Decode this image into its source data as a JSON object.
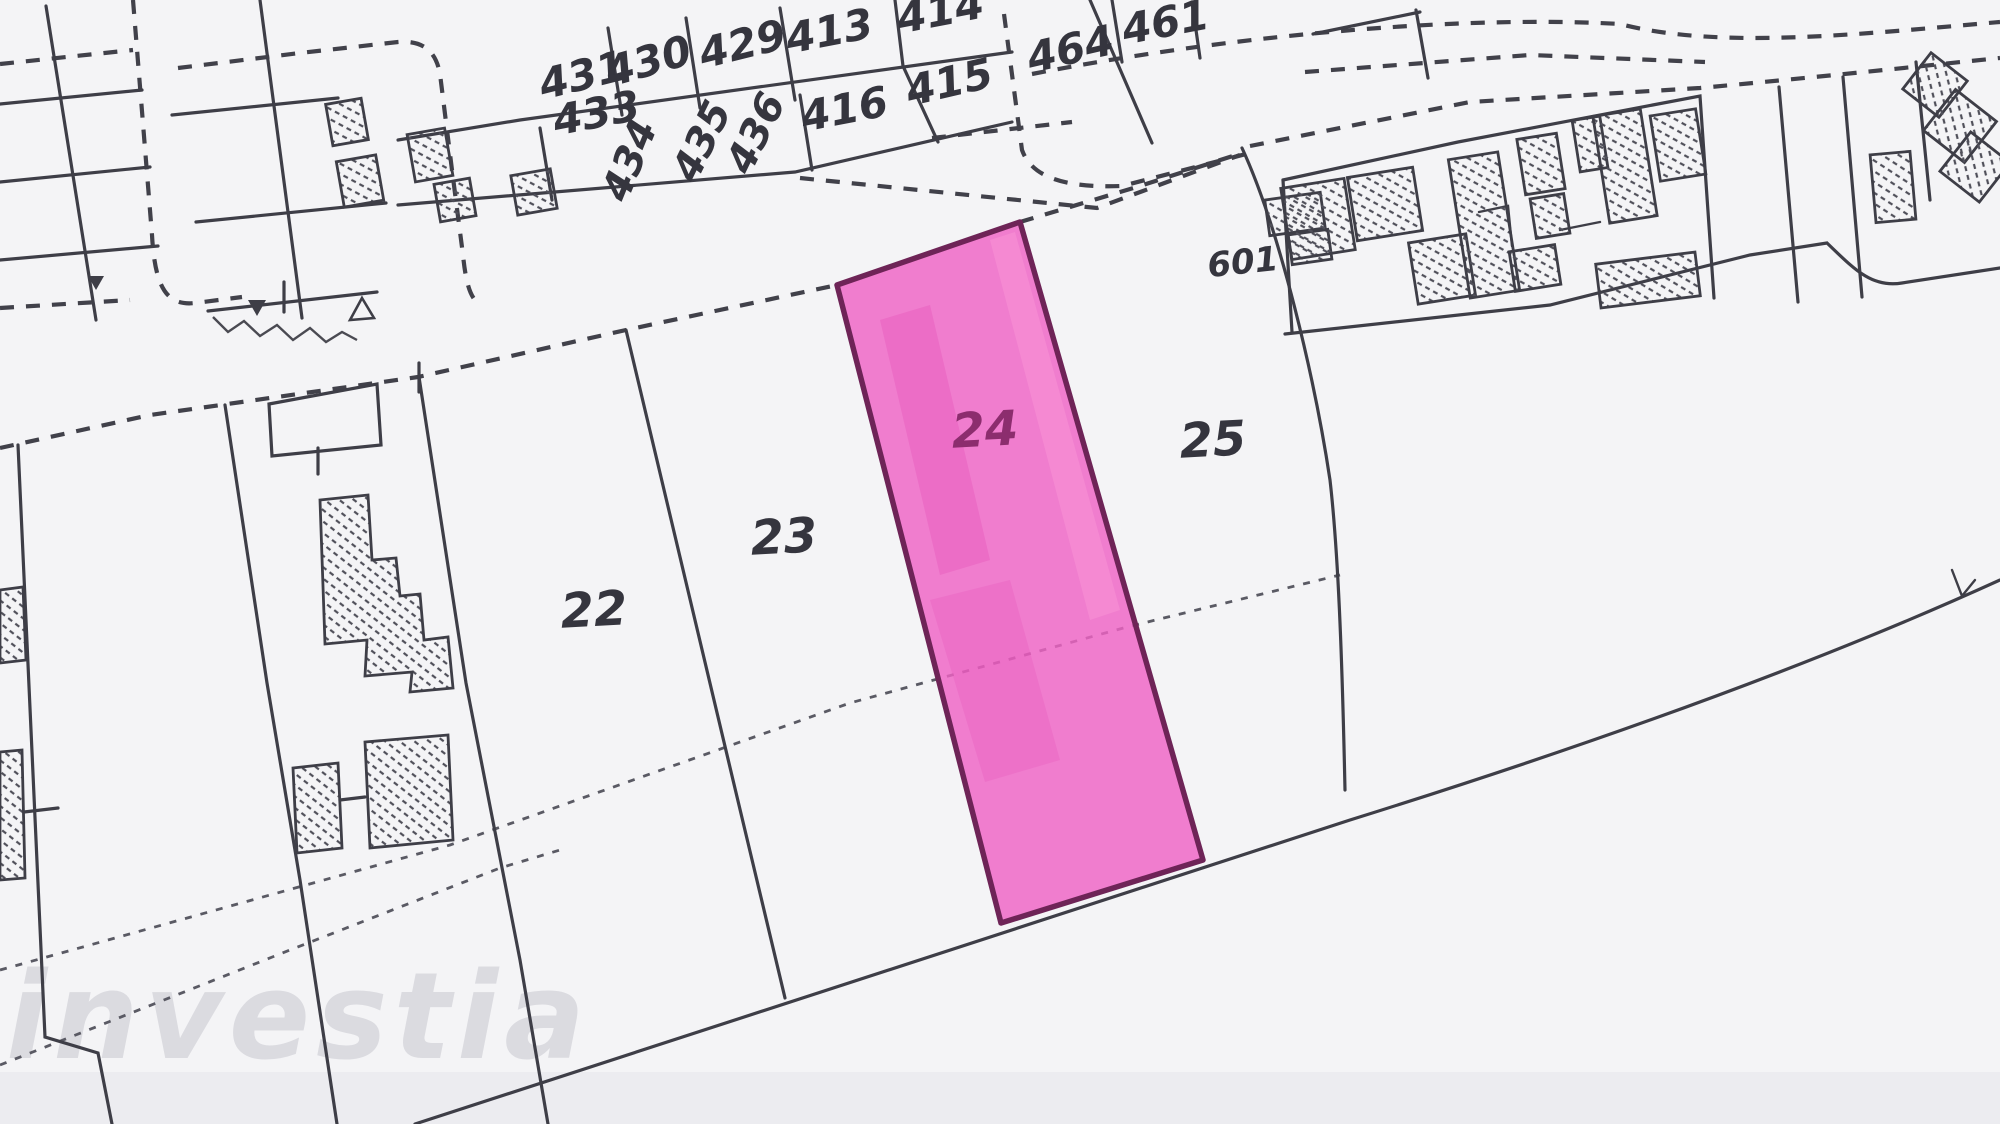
{
  "title": "Scanned cadastral plot plan with parcel 24 highlighted",
  "colors": {
    "background": "#f4f4f6",
    "line": "#3e3e47",
    "dash": "#41414a",
    "fine_dash": "#5a5a64",
    "hatch": "#50505a",
    "label": "#35353e",
    "label_highlight": "#8c2d6e",
    "parcel_fill": "#ef63c5",
    "parcel_outline": "#6e2457",
    "watermark": "#d7d7dd"
  },
  "watermark": {
    "text": "investia"
  },
  "highlighted_parcel": {
    "id": "24",
    "fill": "#ef63c5",
    "outline": "#6e2457"
  },
  "parcel_labels": [
    {
      "id": "431",
      "text": "431",
      "x": 583,
      "y": 78,
      "rot": -14,
      "size": 42
    },
    {
      "id": "433",
      "text": "433",
      "x": 597,
      "y": 116,
      "rot": -11,
      "size": 42
    },
    {
      "id": "430",
      "text": "430",
      "x": 649,
      "y": 64,
      "rot": -16,
      "size": 42
    },
    {
      "id": "429",
      "text": "429",
      "x": 743,
      "y": 47,
      "rot": -14,
      "size": 42
    },
    {
      "id": "413",
      "text": "413",
      "x": 830,
      "y": 34,
      "rot": -11,
      "size": 42
    },
    {
      "id": "414",
      "text": "414",
      "x": 941,
      "y": 14,
      "rot": -11,
      "size": 42
    },
    {
      "id": "415",
      "text": "415",
      "x": 950,
      "y": 85,
      "rot": -13,
      "size": 42
    },
    {
      "id": "416",
      "text": "416",
      "x": 845,
      "y": 112,
      "rot": -11,
      "size": 42
    },
    {
      "id": "434",
      "text": "434",
      "x": 632,
      "y": 161,
      "rot": -68,
      "size": 40
    },
    {
      "id": "435",
      "text": "435",
      "x": 704,
      "y": 142,
      "rot": -64,
      "size": 40
    },
    {
      "id": "436",
      "text": "436",
      "x": 758,
      "y": 134,
      "rot": -64,
      "size": 40
    },
    {
      "id": "464",
      "text": "464",
      "x": 1071,
      "y": 52,
      "rot": -13,
      "size": 42
    },
    {
      "id": "461",
      "text": "461",
      "x": 1166,
      "y": 25,
      "rot": -11,
      "size": 42
    },
    {
      "id": "601",
      "text": "601",
      "x": 1243,
      "y": 264,
      "rot": -6,
      "size": 34
    },
    {
      "id": "22",
      "text": "22",
      "x": 594,
      "y": 613,
      "rot": -3,
      "size": 48
    },
    {
      "id": "23",
      "text": "23",
      "x": 784,
      "y": 540,
      "rot": -3,
      "size": 48
    },
    {
      "id": "24",
      "text": "24",
      "x": 985,
      "y": 433,
      "rot": -3,
      "size": 48,
      "color": "#8c2d6e"
    },
    {
      "id": "25",
      "text": "25",
      "x": 1213,
      "y": 443,
      "rot": -3,
      "size": 48
    }
  ]
}
